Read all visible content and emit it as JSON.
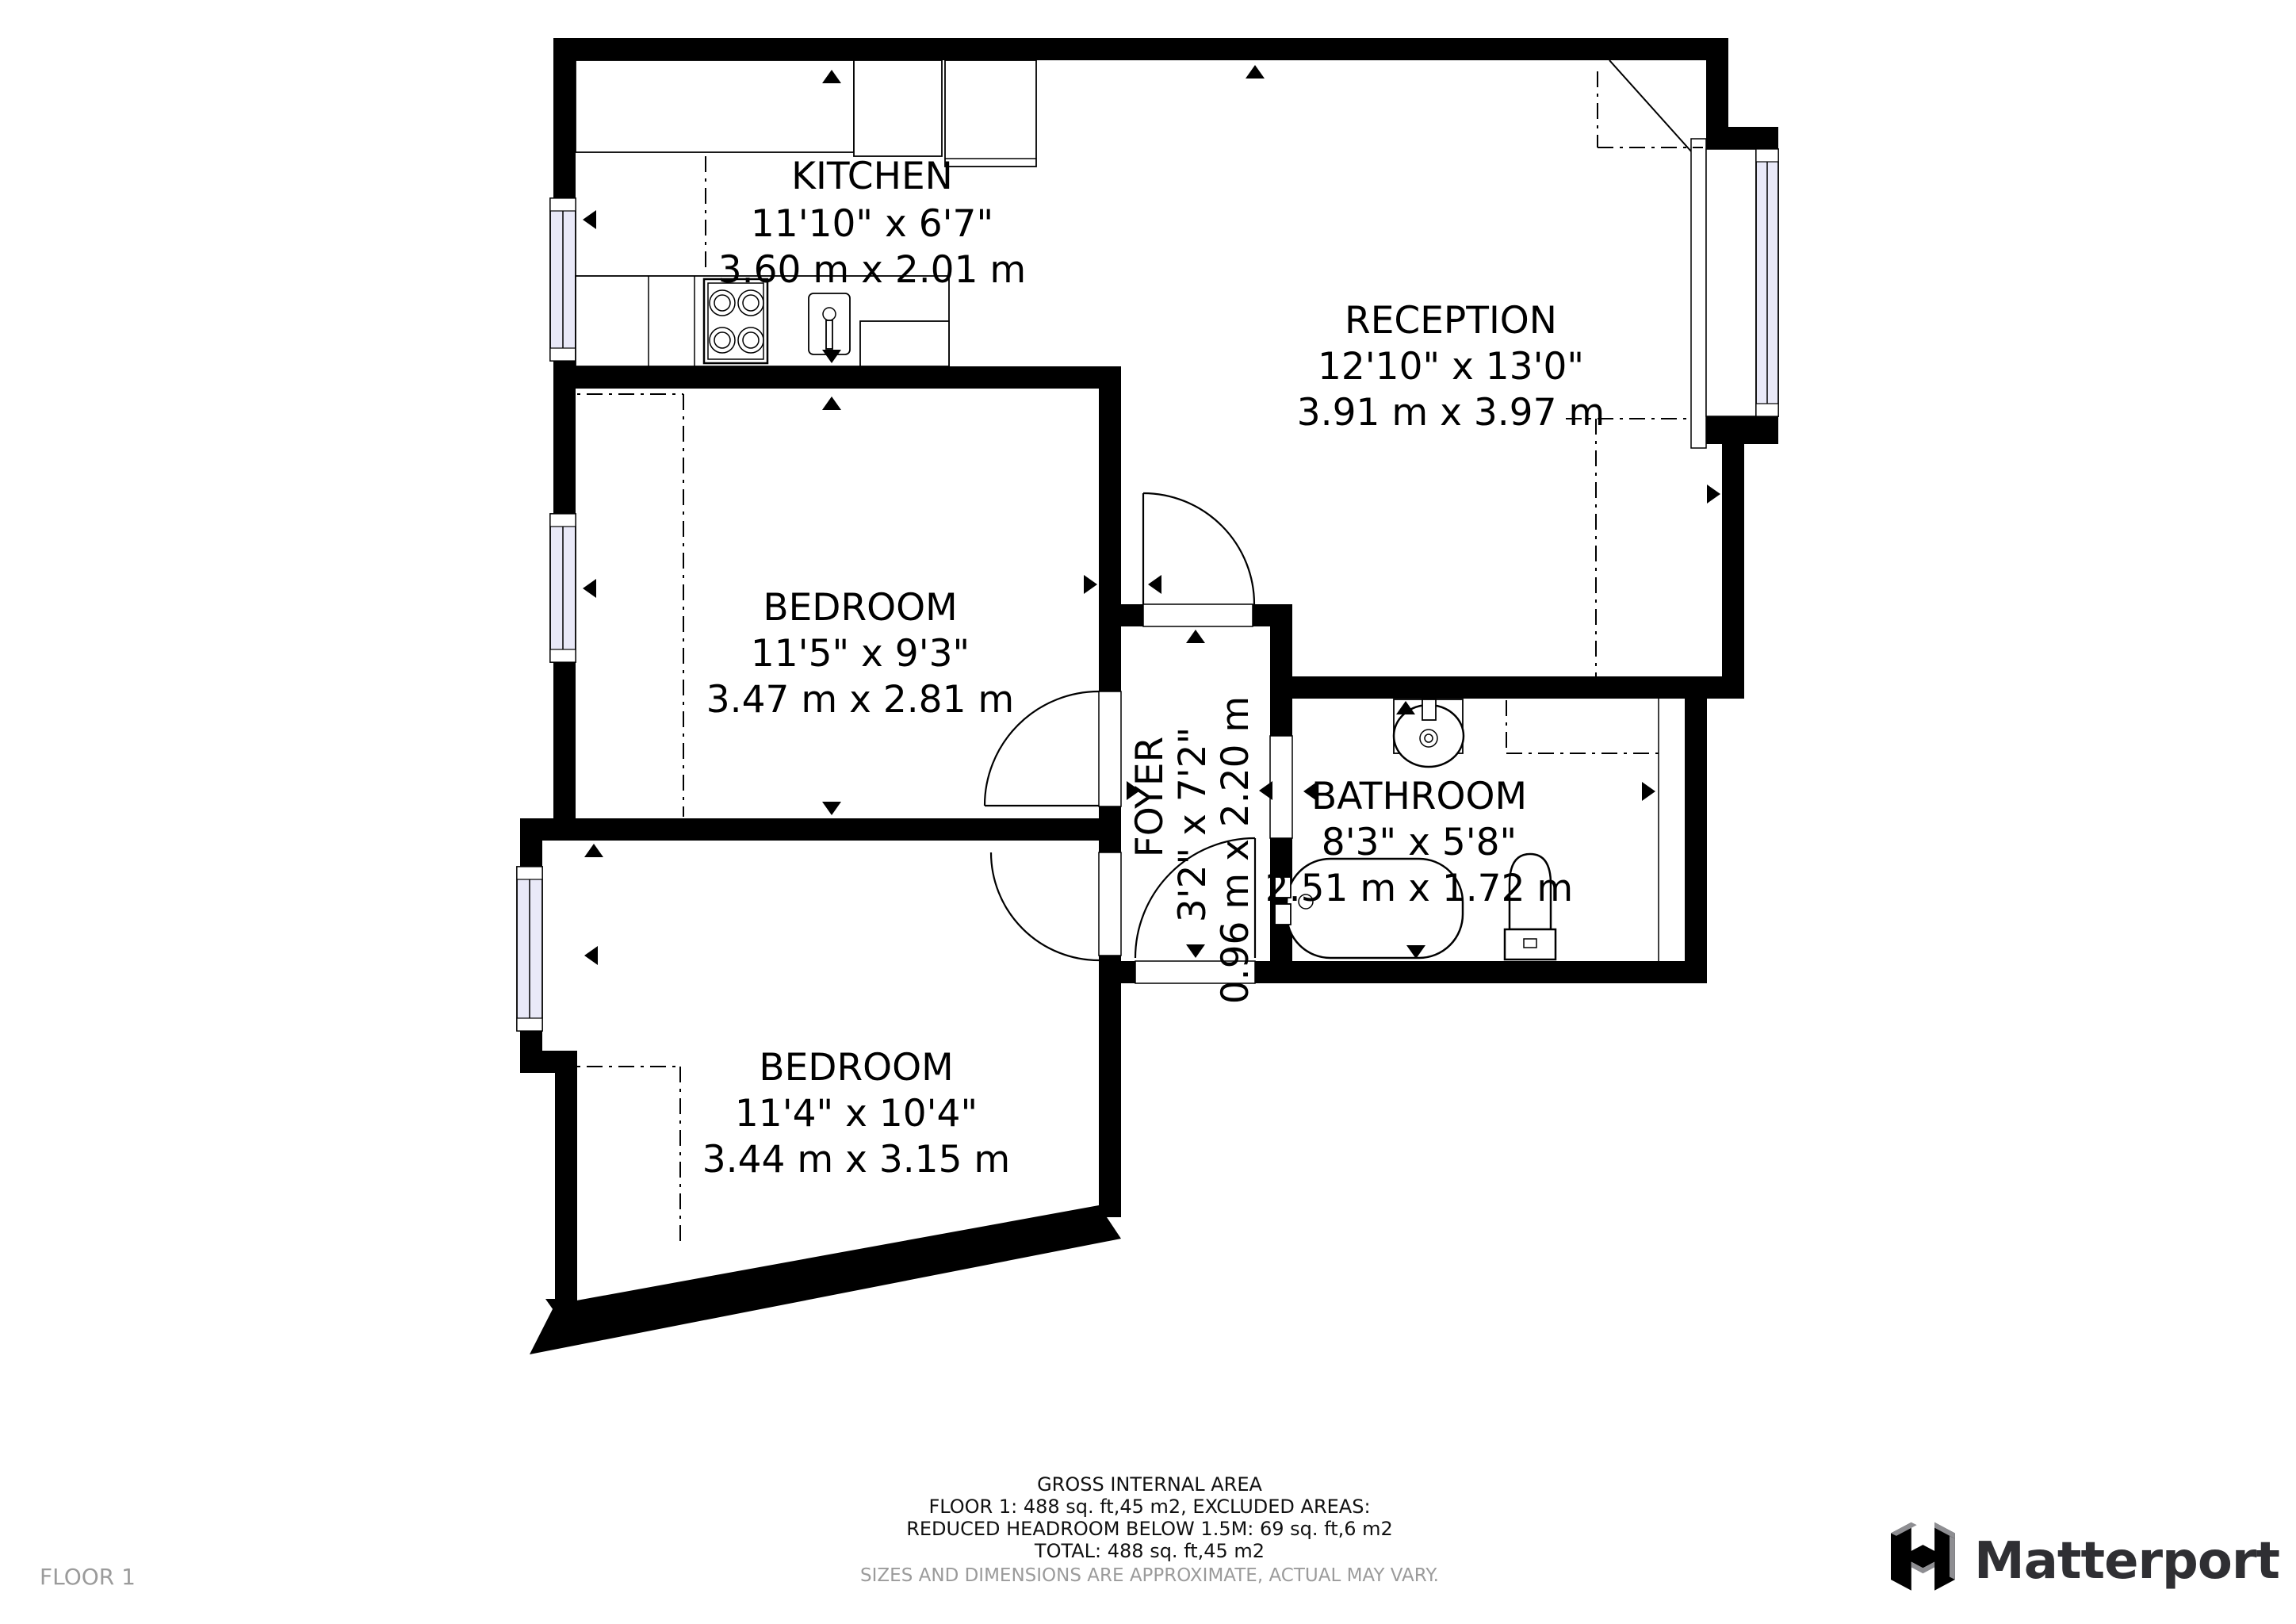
{
  "rooms": [
    {
      "id": "kitchen",
      "name": "KITCHEN",
      "imperial": "11'10\" x 6'7\"",
      "metric": "3.60 m x 2.01 m"
    },
    {
      "id": "reception",
      "name": "RECEPTION",
      "imperial": "12'10\" x 13'0\"",
      "metric": "3.91 m x 3.97 m"
    },
    {
      "id": "bedroom-1",
      "name": "BEDROOM",
      "imperial": "11'5\" x 9'3\"",
      "metric": "3.47 m x 2.81 m"
    },
    {
      "id": "foyer",
      "name": "FOYER",
      "imperial": "3'2\" x 7'2\"",
      "metric": "0.96 m x 2.20 m"
    },
    {
      "id": "bathroom",
      "name": "BATHROOM",
      "imperial": "8'3\" x 5'8\"",
      "metric": "2.51 m x 1.72 m"
    },
    {
      "id": "bedroom-2",
      "name": "BEDROOM",
      "imperial": "11'4\" x 10'4\"",
      "metric": "3.44 m x 3.15 m"
    }
  ],
  "footer": {
    "line1": "GROSS INTERNAL AREA",
    "line2": "FLOOR 1: 488 sq. ft,45 m2, EXCLUDED AREAS:",
    "line3": "REDUCED HEADROOM BELOW 1.5M: 69 sq. ft,6 m2",
    "line4": "TOTAL: 488 sq. ft,45 m2",
    "disclaimer": "SIZES AND DIMENSIONS ARE APPROXIMATE, ACTUAL MAY VARY."
  },
  "floor_label": "FLOOR 1",
  "brand": {
    "name": "Matterport"
  },
  "colors": {
    "wall": "#000000",
    "window_glass": "#e9e9f8",
    "muted_text": "#9b9b9b",
    "logo_text": "#2f2f33",
    "logo_gray": "#8e8e92"
  }
}
